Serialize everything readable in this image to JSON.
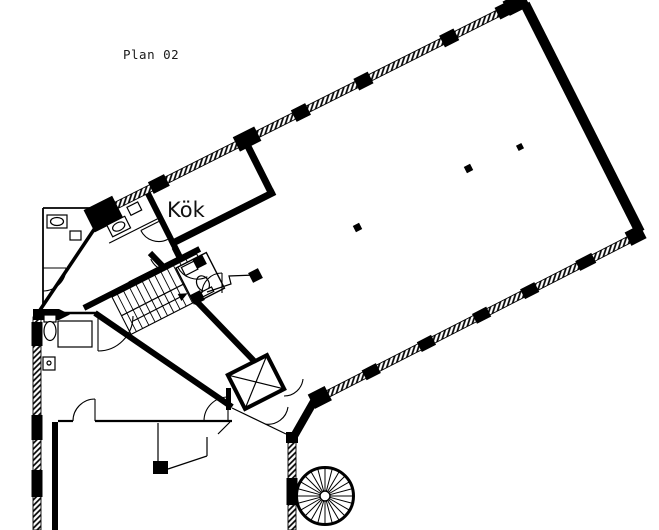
{
  "colors": {
    "ink": "#000000",
    "paper": "#ffffff"
  },
  "plan": {
    "title": "Plan 02",
    "rooms": [
      {
        "name": "kitchen",
        "label": "Kök"
      }
    ],
    "features": [
      {
        "name": "window-wall"
      },
      {
        "name": "main-staircase"
      },
      {
        "name": "spiral-staircase"
      },
      {
        "name": "elevator"
      },
      {
        "name": "wc-toilet"
      },
      {
        "name": "washbasin"
      },
      {
        "name": "door-swing"
      },
      {
        "name": "column"
      },
      {
        "name": "reception-counter"
      }
    ]
  }
}
